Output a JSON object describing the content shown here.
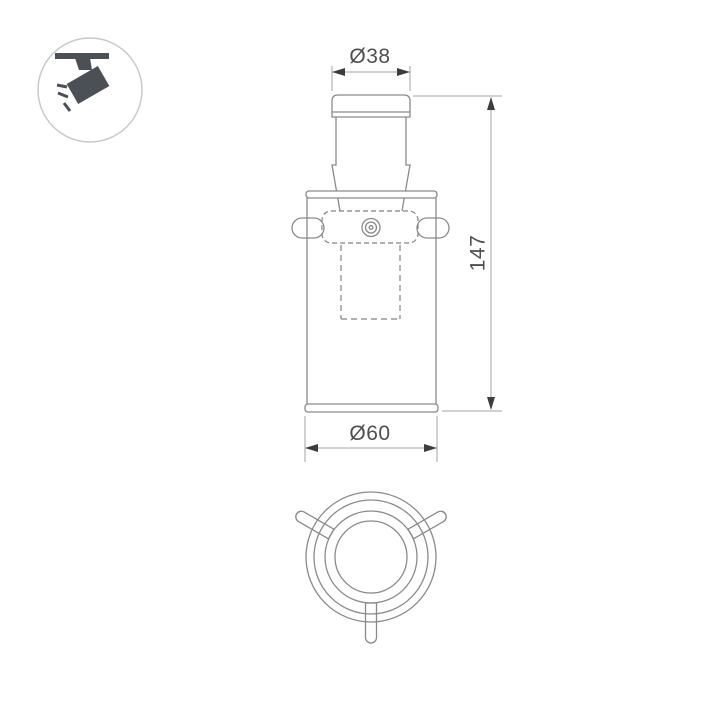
{
  "page": {
    "background": "#ffffff",
    "type": "technical-drawing-sheet"
  },
  "icon_badge": {
    "name": "track-spotlight-icon",
    "description": "ceiling track light pictogram in circle",
    "glyph_color": "#4a5056",
    "circle_color": "#c9c9c9"
  },
  "drawing": {
    "product": "track spotlight luminaire",
    "views": {
      "front": {
        "name": "front elevation view"
      },
      "bottom": {
        "name": "bottom plan view"
      }
    },
    "dimensions": [
      {
        "id": "top_diameter",
        "label": "Ø38",
        "value": 38,
        "kind": "diameter",
        "applies_to": "top cap"
      },
      {
        "id": "overall_height",
        "label": "147",
        "value": 147,
        "kind": "linear",
        "applies_to": "overall height"
      },
      {
        "id": "base_diameter",
        "label": "Ø60",
        "value": 60,
        "kind": "diameter",
        "applies_to": "body base"
      }
    ],
    "colors": {
      "outline": "#8a8a8a",
      "hidden_line": "#858585",
      "dimension_line": "#a3a3a3",
      "arrow": "#3d3d3d",
      "text": "#4f4f4f"
    }
  }
}
